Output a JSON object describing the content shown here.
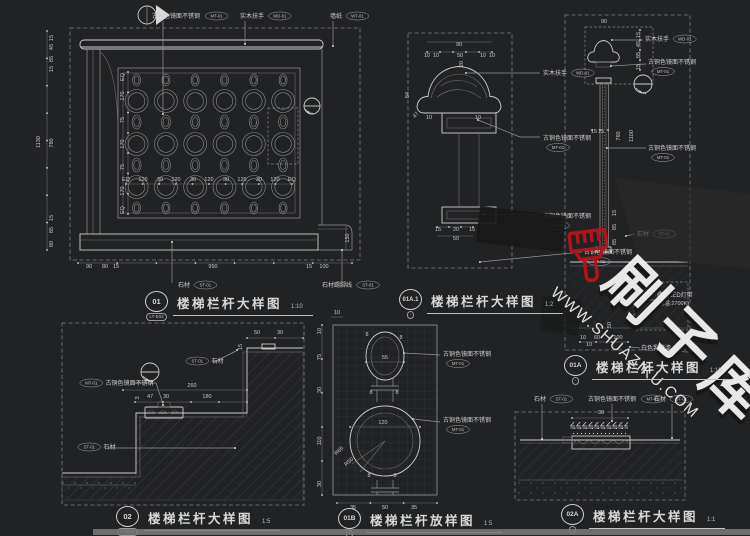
{
  "colors": {
    "background": "#212224",
    "line": "#969696",
    "bright_line": "#cfcfcf",
    "dim_text": "#c8c8c8",
    "watermark_red": "#b1151b",
    "watermark_text": "#efefef"
  },
  "watermark": {
    "site": "WWW.SHUAZIKU.COM",
    "brand": "刷子库",
    "icon": "paint-brush-icon"
  },
  "drawings": [
    {
      "num": "01",
      "code": "LT-E02",
      "title": "楼梯栏杆大样图",
      "scale": "1:10"
    },
    {
      "num": "01A.1",
      "code": "-",
      "title": "楼梯栏杆大样图",
      "scale": "1:2"
    },
    {
      "num": "01A",
      "code": "-",
      "title": "楼梯栏杆大样图",
      "scale": "1:10"
    },
    {
      "num": "02",
      "code": "LT-E02",
      "title": "楼梯栏杆大样图",
      "scale": "1:5"
    },
    {
      "num": "01B",
      "code": "-",
      "title": "楼梯栏杆放样图",
      "scale": "1:5",
      "note": "注: 每格子为10X10mm"
    },
    {
      "num": "02A",
      "code": "-",
      "title": "楼梯栏杆大样图",
      "scale": "1:1"
    }
  ],
  "labels": [
    {
      "d": 0,
      "t": "古铜色镜面不锈钢",
      "tag": "MT-01",
      "x": 152,
      "y": 18
    },
    {
      "d": 0,
      "t": "实木扶手",
      "tag": "WD-01",
      "x": 240,
      "y": 18
    },
    {
      "d": 0,
      "t": "墙纸",
      "tag": "WT-01",
      "x": 330,
      "y": 18
    },
    {
      "d": 0,
      "t": "石材",
      "tag": "ST-01",
      "x": 178,
      "y": 287
    },
    {
      "d": 0,
      "t": "石材踢脚线",
      "tag": "ST-01",
      "x": 322,
      "y": 287
    },
    {
      "d": 1,
      "t": "实木扶手",
      "tag": "WD-01",
      "x": 543,
      "y": 75
    },
    {
      "d": 1,
      "t": "古铜色镜面不锈钢",
      "tag": "MT-01",
      "tb": 1,
      "x": 543,
      "y": 140
    },
    {
      "d": 1,
      "t": "古铜色镜面不锈钢",
      "tag": "MT-01",
      "tb": 1,
      "x": 543,
      "y": 218
    },
    {
      "d": 1,
      "t": "古铜色镜面不锈钢",
      "tag": "MT-01",
      "tb": 1,
      "x": 584,
      "y": 254
    },
    {
      "d": 2,
      "t": "实木扶手",
      "tag": "WD-01",
      "x": 645,
      "y": 41
    },
    {
      "d": 2,
      "t": "古铜色镜面不锈钢",
      "tag": "MT-01",
      "tb": 1,
      "x": 648,
      "y": 64
    },
    {
      "d": 2,
      "t": "古铜色镜面不锈钢",
      "tag": "MT-01",
      "tb": 1,
      "x": 648,
      "y": 150
    },
    {
      "d": 2,
      "t": "石材",
      "tag": "ST-01",
      "x": 637,
      "y": 236
    },
    {
      "d": 2,
      "t": "暗藏LED灯带",
      "t2": "(色温:2700K)",
      "x": 657,
      "y": 297
    },
    {
      "d": 2,
      "t": "白色乳胶漆",
      "tag": "PT-01",
      "x": 641,
      "y": 350
    },
    {
      "d": 3,
      "t": "古铜色镜面不锈钢",
      "tag": "MT-01",
      "tf": 1,
      "x": 80,
      "y": 385
    },
    {
      "d": 3,
      "t": "石材",
      "tag": "ST-01",
      "tf": 1,
      "x": 186,
      "y": 363
    },
    {
      "d": 3,
      "t": "石材",
      "tag": "ST-01",
      "tf": 1,
      "x": 78,
      "y": 449
    },
    {
      "d": 4,
      "t": "古铜色镜面不锈钢",
      "tag": "MT-01",
      "tb": 1,
      "x": 443,
      "y": 356
    },
    {
      "d": 4,
      "t": "古铜色镜面不锈钢",
      "tag": "MT-01",
      "tb": 1,
      "x": 443,
      "y": 422
    },
    {
      "d": 5,
      "t": "石材",
      "tag": "ST-01",
      "x": 534,
      "y": 401
    },
    {
      "d": 5,
      "t": "古铜色镜面不锈钢",
      "tag": "MT-01",
      "x": 588,
      "y": 401
    },
    {
      "d": 5,
      "t": "石材",
      "tag": "ST-01",
      "x": 654,
      "y": 401
    }
  ],
  "dims": [
    {
      "t": "1130",
      "x": 40,
      "y": 142,
      "r": -90
    },
    {
      "t": "15",
      "x": 53,
      "y": 38,
      "r": -90
    },
    {
      "t": "45",
      "x": 53,
      "y": 47,
      "r": -90
    },
    {
      "t": "85",
      "x": 53,
      "y": 59,
      "r": -90
    },
    {
      "t": "15",
      "x": 53,
      "y": 69,
      "r": -90
    },
    {
      "t": "780",
      "x": 53,
      "y": 143,
      "r": -90
    },
    {
      "t": "15",
      "x": 53,
      "y": 218,
      "r": -90
    },
    {
      "t": "85",
      "x": 53,
      "y": 230,
      "r": -90
    },
    {
      "t": "80",
      "x": 53,
      "y": 244,
      "r": -90
    },
    {
      "t": "EQ",
      "x": 124,
      "y": 77,
      "r": -90
    },
    {
      "t": "170",
      "x": 124,
      "y": 96,
      "r": -90
    },
    {
      "t": "75",
      "x": 124,
      "y": 120,
      "r": -90
    },
    {
      "t": "170",
      "x": 124,
      "y": 144,
      "r": -90
    },
    {
      "t": "75",
      "x": 124,
      "y": 167,
      "r": -90
    },
    {
      "t": "170",
      "x": 124,
      "y": 191,
      "r": -90
    },
    {
      "t": "EQ",
      "x": 124,
      "y": 210,
      "r": -90
    },
    {
      "t": "EQ",
      "x": 126,
      "y": 181
    },
    {
      "t": "120",
      "x": 143,
      "y": 181
    },
    {
      "t": "30",
      "x": 160,
      "y": 181
    },
    {
      "t": "120",
      "x": 176,
      "y": 181
    },
    {
      "t": "30",
      "x": 193,
      "y": 181
    },
    {
      "t": "120",
      "x": 209,
      "y": 181
    },
    {
      "t": "30",
      "x": 226,
      "y": 181
    },
    {
      "t": "120",
      "x": 242,
      "y": 181
    },
    {
      "t": "30",
      "x": 259,
      "y": 181
    },
    {
      "t": "120",
      "x": 275,
      "y": 181
    },
    {
      "t": "EQ",
      "x": 292,
      "y": 181
    },
    {
      "t": "90",
      "x": 89,
      "y": 268
    },
    {
      "t": "80",
      "x": 105,
      "y": 268
    },
    {
      "t": "15",
      "x": 116,
      "y": 268
    },
    {
      "t": "950",
      "x": 213,
      "y": 268
    },
    {
      "t": "15",
      "x": 309,
      "y": 268
    },
    {
      "t": "100",
      "x": 324,
      "y": 268
    },
    {
      "t": "150",
      "x": 349,
      "y": 238,
      "r": -90
    },
    {
      "t": "90",
      "x": 459,
      "y": 46
    },
    {
      "t": "10",
      "x": 427,
      "y": 57
    },
    {
      "t": "10",
      "x": 436,
      "y": 57
    },
    {
      "t": "50",
      "x": 460,
      "y": 57
    },
    {
      "t": "10",
      "x": 483,
      "y": 57
    },
    {
      "t": "10",
      "x": 492,
      "y": 57
    },
    {
      "t": "20",
      "x": 463,
      "y": 64,
      "r": -90
    },
    {
      "t": "84",
      "x": 409,
      "y": 95,
      "r": -90
    },
    {
      "t": "47",
      "x": 417,
      "y": 116,
      "r": -50
    },
    {
      "t": "10",
      "x": 429,
      "y": 119
    },
    {
      "t": "10",
      "x": 478,
      "y": 119
    },
    {
      "t": "15",
      "x": 438,
      "y": 231
    },
    {
      "t": "20",
      "x": 456,
      "y": 231
    },
    {
      "t": "15",
      "x": 472,
      "y": 231
    },
    {
      "t": "50",
      "x": 456,
      "y": 240
    },
    {
      "t": "90",
      "x": 604,
      "y": 23
    },
    {
      "t": "15",
      "x": 640,
      "y": 35,
      "r": -90
    },
    {
      "t": "45",
      "x": 640,
      "y": 44,
      "r": -90
    },
    {
      "t": "85",
      "x": 640,
      "y": 55,
      "r": -90
    },
    {
      "t": "15",
      "x": 640,
      "y": 67,
      "r": -90
    },
    {
      "t": "15",
      "x": 594,
      "y": 133
    },
    {
      "t": "15",
      "x": 601,
      "y": 133
    },
    {
      "t": "760",
      "x": 620,
      "y": 136,
      "r": -90
    },
    {
      "t": "1100",
      "x": 633,
      "y": 136,
      "r": -90
    },
    {
      "t": "15",
      "x": 616,
      "y": 213,
      "r": -90
    },
    {
      "t": "85",
      "x": 616,
      "y": 227,
      "r": -90
    },
    {
      "t": "85",
      "x": 616,
      "y": 242,
      "r": -90
    },
    {
      "t": "100",
      "x": 633,
      "y": 303
    },
    {
      "t": "50",
      "x": 611,
      "y": 325,
      "r": -90
    },
    {
      "t": "10",
      "x": 583,
      "y": 339
    },
    {
      "t": "60",
      "x": 597,
      "y": 339
    },
    {
      "t": "100",
      "x": 618,
      "y": 339
    },
    {
      "t": "10",
      "x": 589,
      "y": 346
    },
    {
      "t": "50",
      "x": 257,
      "y": 334
    },
    {
      "t": "30",
      "x": 280,
      "y": 334
    },
    {
      "t": "15",
      "x": 242,
      "y": 347,
      "r": -90
    },
    {
      "t": "260",
      "x": 192,
      "y": 387
    },
    {
      "t": "3",
      "x": 139,
      "y": 398,
      "r": -90
    },
    {
      "t": "47",
      "x": 150,
      "y": 398
    },
    {
      "t": "30",
      "x": 166,
      "y": 398
    },
    {
      "t": "180",
      "x": 207,
      "y": 398
    },
    {
      "t": "10",
      "x": 337,
      "y": 314
    },
    {
      "t": "10",
      "x": 321,
      "y": 331,
      "r": -90
    },
    {
      "t": "75",
      "x": 321,
      "y": 357,
      "r": -90
    },
    {
      "t": "30",
      "x": 321,
      "y": 390,
      "r": -90
    },
    {
      "t": "110",
      "x": 321,
      "y": 441,
      "r": -90
    },
    {
      "t": "30",
      "x": 321,
      "y": 484,
      "r": -90
    },
    {
      "t": "55",
      "x": 385,
      "y": 359
    },
    {
      "t": "120",
      "x": 383,
      "y": 424
    },
    {
      "t": "R65",
      "x": 340,
      "y": 452,
      "r": -42
    },
    {
      "t": "R50",
      "x": 350,
      "y": 463,
      "r": -42
    },
    {
      "t": "8",
      "x": 367,
      "y": 336
    },
    {
      "t": "8",
      "x": 401,
      "y": 339
    },
    {
      "t": "8",
      "x": 371,
      "y": 394
    },
    {
      "t": "8",
      "x": 397,
      "y": 394
    },
    {
      "t": "8",
      "x": 369,
      "y": 477
    },
    {
      "t": "8",
      "x": 395,
      "y": 477
    },
    {
      "t": "35",
      "x": 353,
      "y": 509
    },
    {
      "t": "50",
      "x": 385,
      "y": 509
    },
    {
      "t": "35",
      "x": 414,
      "y": 509
    },
    {
      "t": "30",
      "x": 601,
      "y": 414
    }
  ]
}
